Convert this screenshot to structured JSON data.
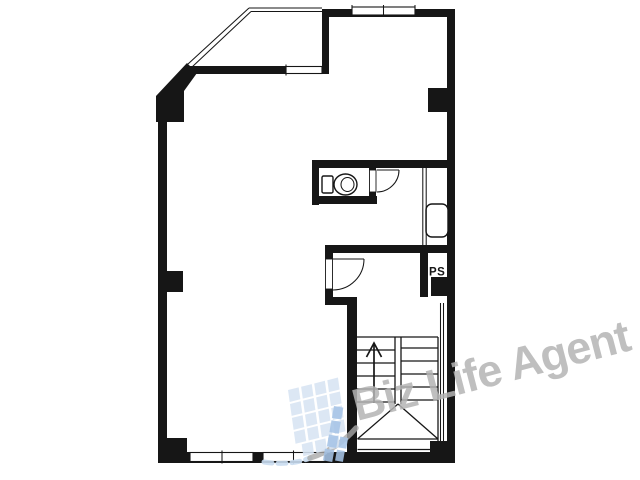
{
  "canvas": {
    "width": 640,
    "height": 480,
    "background_color": "#ffffff"
  },
  "floorplan": {
    "type": "building-floor-plan",
    "wall_color": "#161616",
    "line_color": "#161616",
    "ps_label": "PS",
    "fixtures": [
      "toilet-icon",
      "bathtub-icon",
      "staircase-icon",
      "up-arrow-icon",
      "door-swing-icon",
      "window-icon",
      "pipe-shaft"
    ]
  },
  "watermark": {
    "text": "Biz Life Agent",
    "color": "#b4b4b4",
    "logo_light_color": "#d7e4f3",
    "logo_dark_color": "#a6c4e6",
    "swoosh_color": "#a9a9a9"
  }
}
